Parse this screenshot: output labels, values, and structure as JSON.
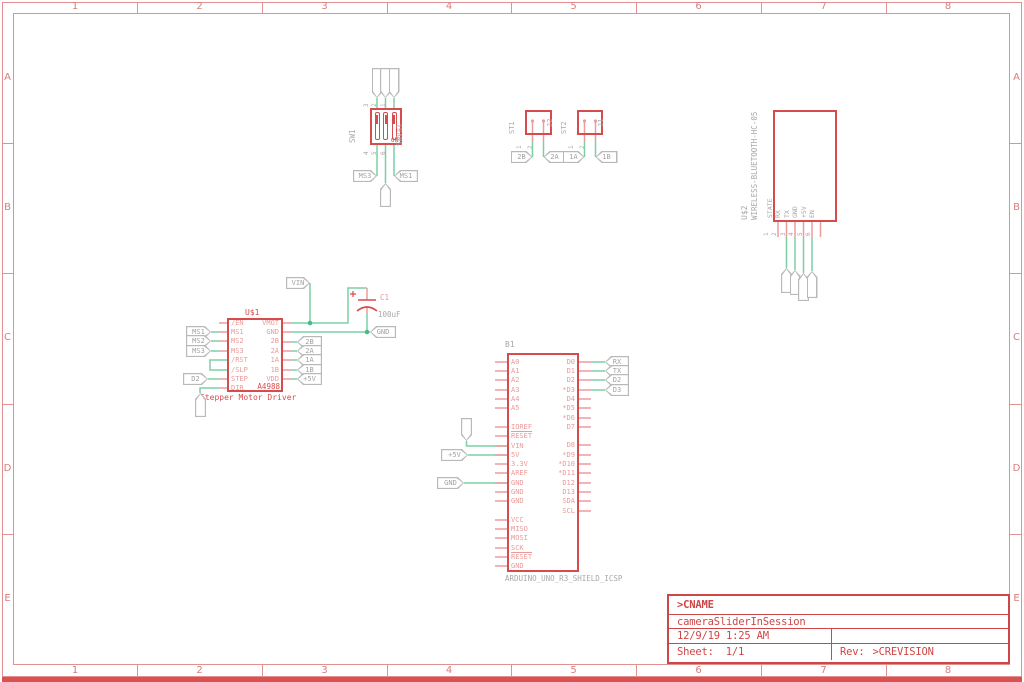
{
  "frame": {
    "columns": [
      "1",
      "2",
      "3",
      "4",
      "5",
      "6",
      "7",
      "8"
    ],
    "rows": [
      "A",
      "B",
      "C",
      "D",
      "E"
    ]
  },
  "title_block": {
    "cname": ">CNAME",
    "project": "cameraSliderInSession",
    "datetime": "12/9/19 1:25 AM",
    "sheet_label": "Sheet:",
    "sheet_value": "1/1",
    "rev_label": "Rev:",
    "rev_value": ">CREVISION"
  },
  "dip_switch": {
    "ref": "SW1",
    "value": "SWVal",
    "on_label": "ON",
    "top_pin_numbers": [
      "3",
      "2",
      "1"
    ],
    "bottom_pin_numbers": [
      "4",
      "5",
      "6"
    ],
    "top_flags": [
      "+5V",
      "+5V",
      "+5V"
    ],
    "bottom_flags": [
      "MS3",
      "MS2",
      "MS1"
    ]
  },
  "terminals": {
    "st1": {
      "ref": "ST1",
      "value": "J2",
      "pins": [
        "1",
        "2"
      ],
      "flags": [
        "2B",
        "2A"
      ]
    },
    "st2": {
      "ref": "ST2",
      "value": "J1",
      "pins": [
        "1",
        "2"
      ],
      "flags": [
        "1A",
        "1B"
      ]
    }
  },
  "bluetooth": {
    "ref": "U$2",
    "value": "WIRELESS-BLUETOOTH-HC-05",
    "pin_numbers": [
      "1",
      "2",
      "3",
      "4",
      "5",
      "6"
    ],
    "pin_names": [
      "STATE",
      "RX",
      "TX",
      "GND",
      "+5V",
      "EN"
    ],
    "flags": [
      "TX",
      "RX",
      "GND",
      "+5V"
    ]
  },
  "stepper": {
    "ref": "U$1",
    "part": "A4988",
    "description": "Stepper Motor Driver",
    "left_pins": [
      "/EN",
      "MS1",
      "MS2",
      "MS3",
      "/RST",
      "/SLP",
      "STEP",
      "DIR"
    ],
    "right_pins": [
      "VMOT",
      "GND",
      "2B",
      "2A",
      "1A",
      "1B",
      "VDD"
    ],
    "left_flags": [
      "MS1",
      "MS2",
      "MS3",
      "D2",
      "D3"
    ],
    "right_flags": [
      "2B",
      "2A",
      "1A",
      "1B",
      "+5V"
    ],
    "vin_flag": "VIN",
    "gnd_flag": "GND",
    "capacitor": {
      "ref": "C1",
      "value": "100uF",
      "polarity": "+"
    }
  },
  "arduino": {
    "ref": "B1",
    "value": "ARDUINO_UNO_R3_SHIELD_ICSP",
    "left_pins": [
      "A0",
      "A1",
      "A2",
      "A3",
      "A4",
      "A5",
      "",
      "IOREF",
      "RESET",
      "VIN",
      "5V",
      "3.3V",
      "AREF",
      "GND",
      "GND",
      "GND",
      "",
      "VCC",
      "MISO",
      "MOSI",
      "SCK",
      "RESET",
      "GND"
    ],
    "right_pins": [
      "D0",
      "D1",
      "D2",
      "*D3",
      "D4",
      "*D5",
      "*D6",
      "D7",
      "",
      "D8",
      "*D9",
      "*D10",
      "*D11",
      "D12",
      "D13",
      "SDA",
      "SCL"
    ],
    "left_flags": [
      "VIN",
      "+5V",
      "GND"
    ],
    "right_flags": [
      "RX",
      "TX",
      "D2",
      "D3"
    ]
  }
}
